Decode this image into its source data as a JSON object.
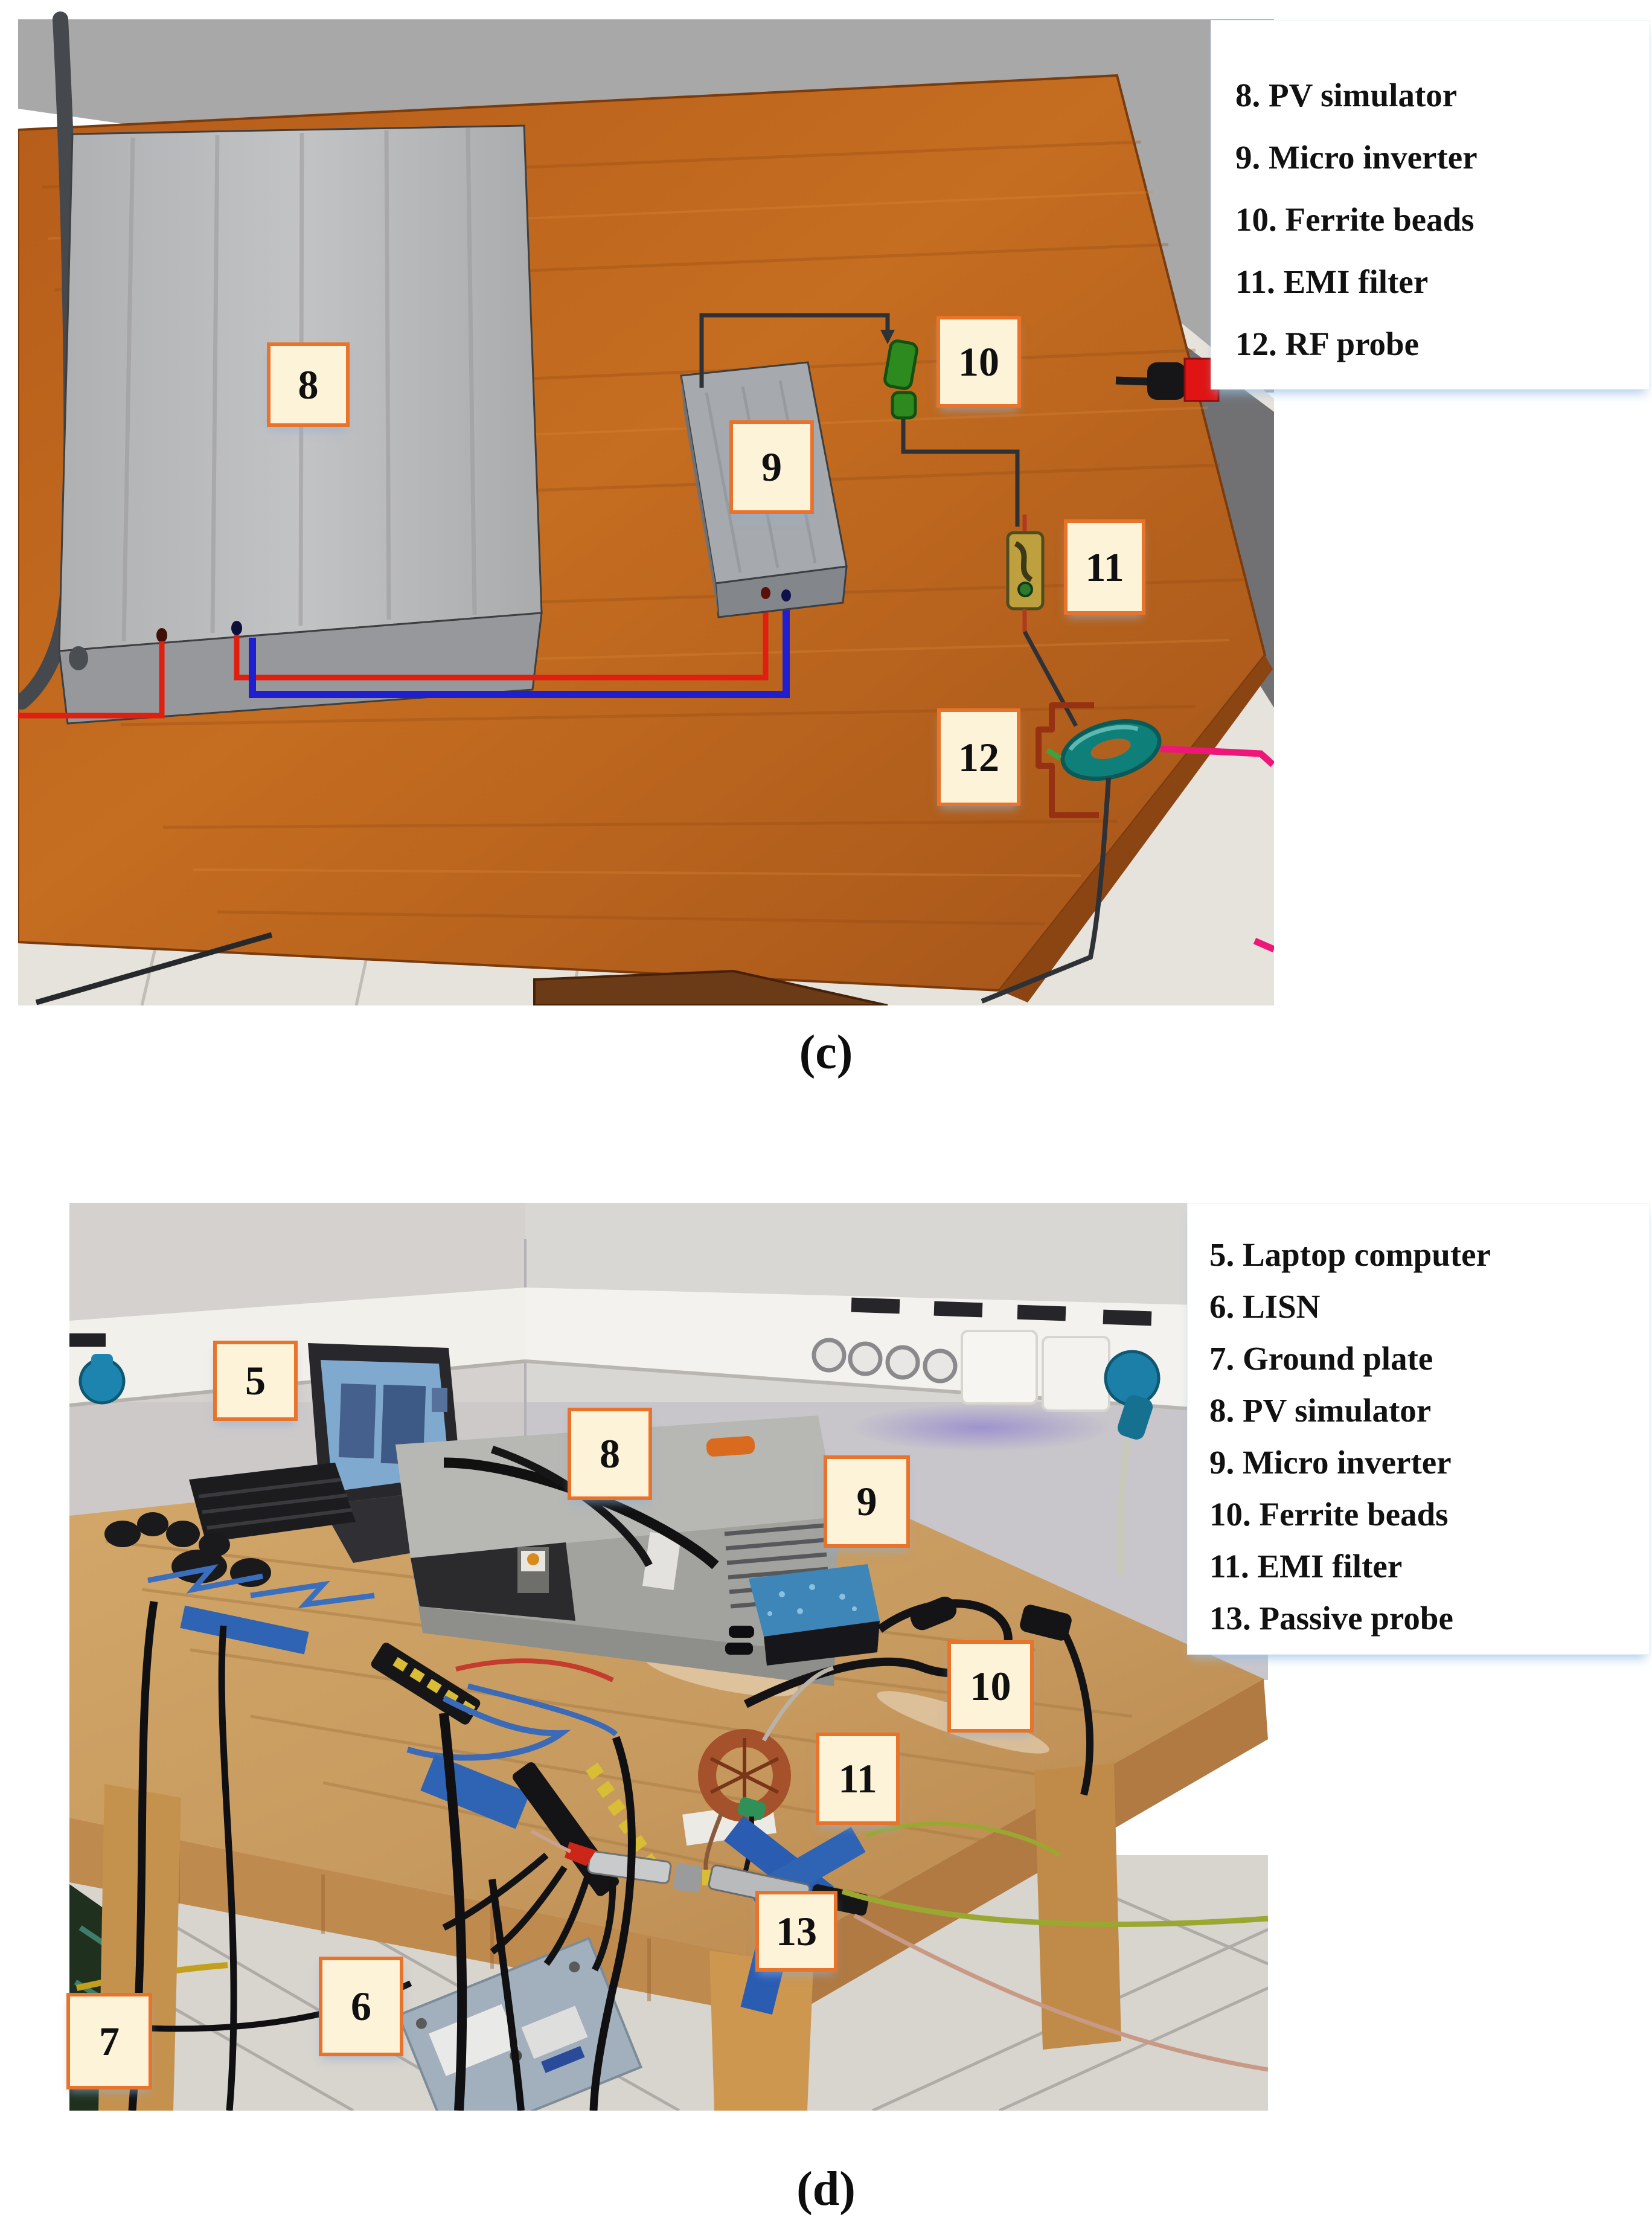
{
  "figure_c": {
    "caption": "(c)",
    "legend": [
      "8. PV simulator",
      "9. Micro inverter",
      "10. Ferrite beads",
      "11. EMI filter",
      "12. RF probe"
    ],
    "markers": [
      {
        "text": "8",
        "meaning": "PV simulator"
      },
      {
        "text": "9",
        "meaning": "Micro inverter"
      },
      {
        "text": "10",
        "meaning": "Ferrite beads"
      },
      {
        "text": "11",
        "meaning": "EMI filter"
      },
      {
        "text": "12",
        "meaning": "RF probe"
      }
    ]
  },
  "figure_d": {
    "caption": "(d)",
    "legend": [
      "5. Laptop computer",
      "6. LISN",
      "7. Ground plate",
      "8. PV simulator",
      "9. Micro inverter",
      "10. Ferrite beads",
      "11. EMI filter",
      "13. Passive probe"
    ],
    "markers": [
      {
        "text": "5",
        "meaning": "Laptop computer"
      },
      {
        "text": "8",
        "meaning": "PV simulator"
      },
      {
        "text": "9",
        "meaning": "Micro inverter"
      },
      {
        "text": "10",
        "meaning": "Ferrite beads"
      },
      {
        "text": "11",
        "meaning": "EMI filter"
      },
      {
        "text": "13",
        "meaning": "Passive probe"
      },
      {
        "text": "6",
        "meaning": "LISN"
      },
      {
        "text": "7",
        "meaning": "Ground plate"
      }
    ]
  },
  "colors": {
    "marker_fill": "#FDF3D8",
    "marker_border": "#E8732A",
    "wood_table_render": "#C0671D",
    "wood_table_photo": "#C79A5F",
    "wall_render": "#A8A8A8",
    "wall_photo": "#CCC9CE",
    "rf_probe_teal": "#0F7F7A",
    "ferrite_green": "#2C8A1E",
    "wire_red": "#E01F10",
    "wire_blue": "#1F1FCF",
    "wire_pink": "#EF1679"
  }
}
